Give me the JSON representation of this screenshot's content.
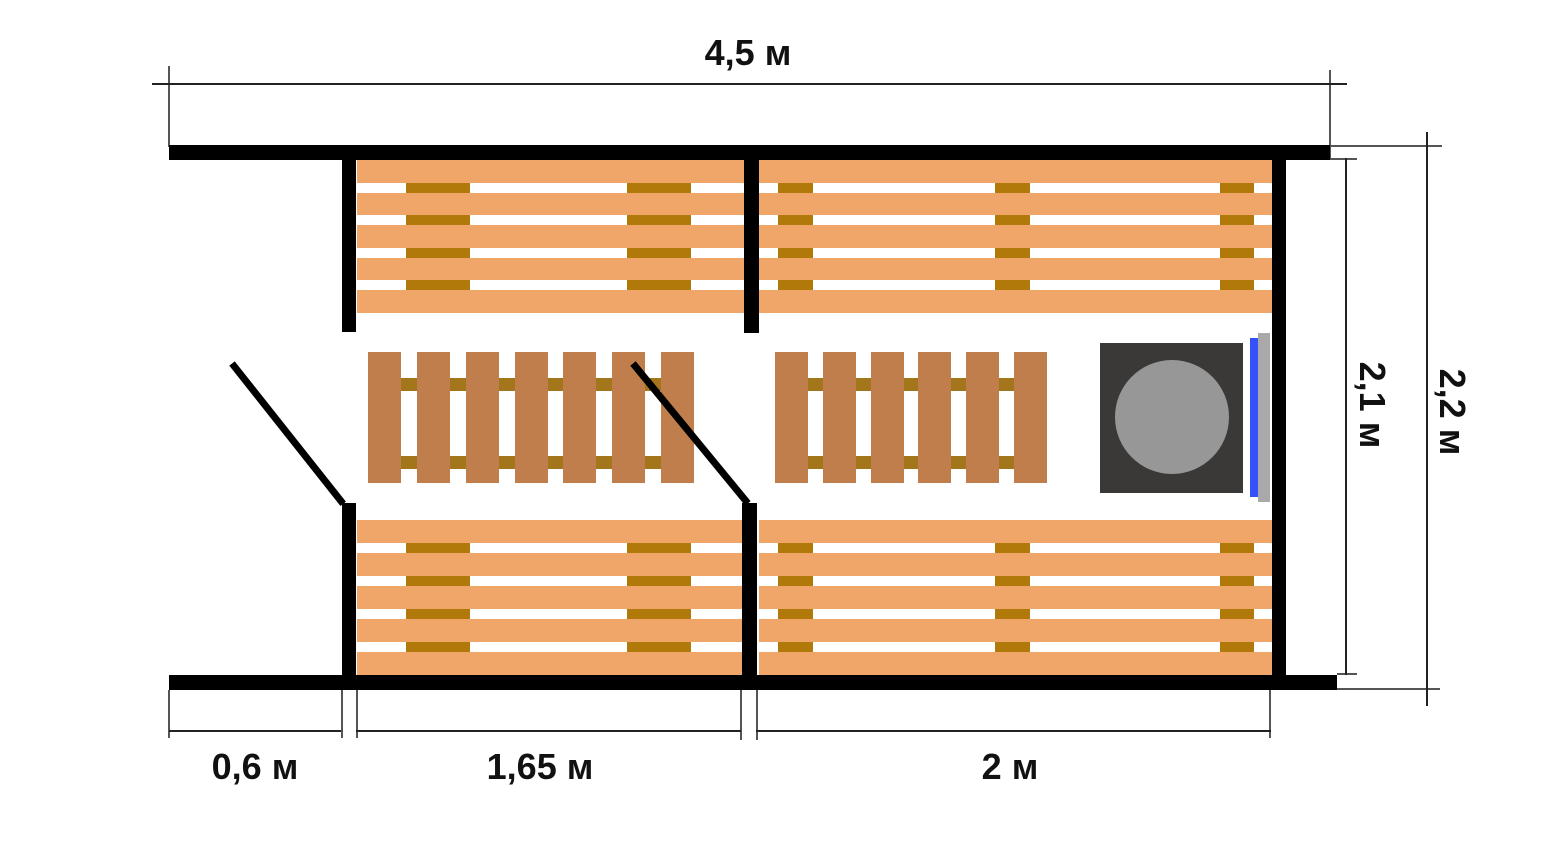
{
  "plan": {
    "kind": "sauna-floor-plan",
    "width": 1550,
    "height": 850
  },
  "dimensions": {
    "top": {
      "label": "4,5 м"
    },
    "right_inner": {
      "label": "2,1 м"
    },
    "right_outer": {
      "label": "2,2 м"
    },
    "bottom_left": {
      "label": "0,6 м"
    },
    "bottom_middle": {
      "label": "1,65 м"
    },
    "bottom_right": {
      "label": "2 м"
    }
  },
  "colors": {
    "wall": "#000000",
    "bench_wood": "#f0a569",
    "bench_gap": "#ffffff",
    "bench_support": "#b1790a",
    "duckboard_plank": "#bf7e4b",
    "duckboard_rail": "#a3761b",
    "stove_body": "#3b3838",
    "stove_lid": "#979797",
    "heater_glass": "#3551fa",
    "heater_frame": "#a9a9a9",
    "door_swing": "#000000",
    "dim_line": "#222222",
    "ext_line": "#555555"
  },
  "geometry": {
    "walls": [
      {
        "name": "wall-top",
        "rect": [
          169,
          145,
          1161,
          15
        ]
      },
      {
        "name": "wall-bottom",
        "rect": [
          169,
          675,
          1168,
          15
        ]
      },
      {
        "name": "wall-right",
        "rect": [
          1272,
          160,
          14,
          515
        ]
      },
      {
        "name": "wall-stub-upper-left",
        "rect": [
          342,
          160,
          14,
          172
        ]
      },
      {
        "name": "wall-stub-lower-left",
        "rect": [
          342,
          503,
          14,
          172
        ]
      },
      {
        "name": "wall-partition-upper",
        "rect": [
          744,
          160,
          15,
          173
        ]
      },
      {
        "name": "wall-stub-lower-middle",
        "rect": [
          742,
          503,
          15,
          172
        ]
      }
    ],
    "door_swings": [
      {
        "name": "door-swing-entry",
        "x": 232,
        "y": 363,
        "len": 179,
        "angle": 51.6,
        "thick": 7
      },
      {
        "name": "door-swing-steamroom",
        "x": 633,
        "y": 363,
        "len": 181,
        "angle": 50.6,
        "thick": 7
      }
    ],
    "benches": [
      {
        "name": "bench-top-left",
        "rect": [
          357,
          160,
          387,
          153
        ],
        "gap": 10,
        "planks": 5,
        "tiles": [
          [
            49,
            64
          ],
          [
            270,
            64
          ]
        ]
      },
      {
        "name": "bench-top-right",
        "rect": [
          759,
          160,
          513,
          153
        ],
        "gap": 10,
        "planks": 5,
        "tiles": [
          [
            19,
            35
          ],
          [
            236,
            35
          ],
          [
            461,
            34
          ]
        ]
      },
      {
        "name": "bench-bottom-left",
        "rect": [
          357,
          520,
          385,
          155
        ],
        "gap": 10,
        "planks": 5,
        "tiles": [
          [
            49,
            64
          ],
          [
            270,
            64
          ]
        ]
      },
      {
        "name": "bench-bottom-right",
        "rect": [
          759,
          520,
          513,
          155
        ],
        "gap": 10,
        "planks": 5,
        "tiles": [
          [
            19,
            35
          ],
          [
            236,
            35
          ],
          [
            461,
            34
          ]
        ]
      }
    ],
    "duckboards": [
      {
        "name": "duckboard-left",
        "rect": [
          368,
          352,
          326,
          131
        ],
        "planks": 7,
        "plank_w": 33,
        "rails": [
          [
            26,
            13
          ],
          [
            104,
            13
          ]
        ]
      },
      {
        "name": "duckboard-right",
        "rect": [
          775,
          352,
          272,
          131
        ],
        "planks": 6,
        "plank_w": 33,
        "rails": [
          [
            26,
            13
          ],
          [
            104,
            13
          ]
        ]
      }
    ],
    "stove": {
      "name": "stove",
      "body": [
        1100,
        343,
        143,
        150
      ],
      "lid_circle": {
        "cx": 72,
        "cy": 74,
        "r": 57
      },
      "glass_strip": [
        1250,
        338,
        8,
        159
      ],
      "frame_strip": [
        1258,
        333,
        12,
        169
      ]
    },
    "dim_lines": [
      {
        "name": "dim-line-top",
        "rect": [
          152,
          83,
          1195,
          2
        ]
      },
      {
        "name": "dim-line-bottom-left",
        "rect": [
          169,
          730,
          172,
          2
        ]
      },
      {
        "name": "dim-line-bottom-middle",
        "rect": [
          356,
          730,
          385,
          2
        ]
      },
      {
        "name": "dim-line-bottom-right",
        "rect": [
          756,
          730,
          515,
          2
        ]
      },
      {
        "name": "dim-line-right-inner",
        "rect": [
          1345,
          158,
          2,
          517
        ]
      },
      {
        "name": "dim-line-right-outer",
        "rect": [
          1426,
          132,
          2,
          574
        ]
      }
    ],
    "ext_lines": [
      {
        "name": "ext-top-left",
        "rect": [
          168,
          66,
          2,
          81
        ]
      },
      {
        "name": "ext-top-right",
        "rect": [
          1329,
          70,
          2,
          90
        ]
      },
      {
        "name": "ext-right-inner-top",
        "rect": [
          1330,
          158,
          27,
          2
        ]
      },
      {
        "name": "ext-right-inner-bottom",
        "rect": [
          1337,
          673,
          20,
          2
        ]
      },
      {
        "name": "ext-right-outer-top",
        "rect": [
          1330,
          145,
          112,
          2
        ]
      },
      {
        "name": "ext-right-outer-bottom",
        "rect": [
          1337,
          688,
          103,
          2
        ]
      },
      {
        "name": "ext-bottom-1",
        "rect": [
          168,
          690,
          2,
          48
        ]
      },
      {
        "name": "ext-bottom-2",
        "rect": [
          341,
          690,
          2,
          48
        ]
      },
      {
        "name": "ext-bottom-3",
        "rect": [
          356,
          690,
          2,
          48
        ]
      },
      {
        "name": "ext-bottom-4",
        "rect": [
          740,
          690,
          2,
          50
        ]
      },
      {
        "name": "ext-bottom-5",
        "rect": [
          756,
          690,
          2,
          50
        ]
      },
      {
        "name": "ext-bottom-6",
        "rect": [
          1269,
          690,
          2,
          48
        ]
      }
    ]
  }
}
